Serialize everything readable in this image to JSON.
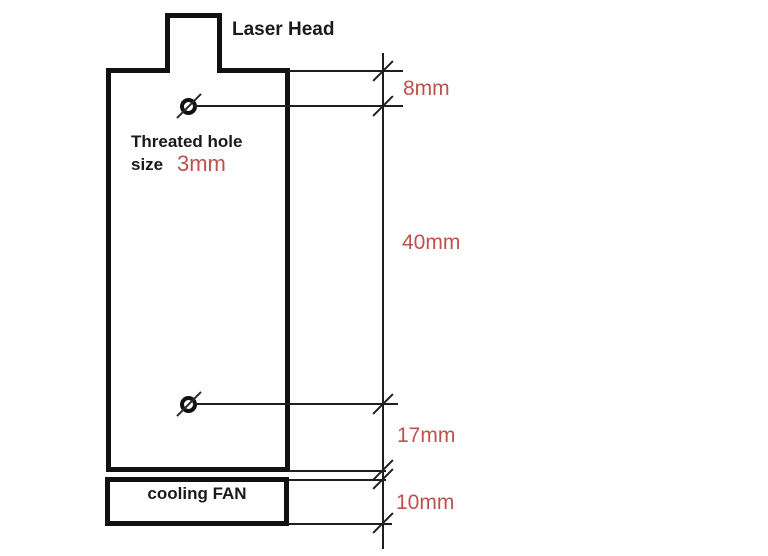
{
  "diagram": {
    "labels": {
      "laser_head": "Laser Head",
      "hole_note_line1": "Threated hole",
      "hole_note_line2": "size",
      "hole_size_value": "3mm",
      "cooling_fan": "cooling FAN"
    },
    "dimensions": {
      "top_edge_to_hole": "8mm",
      "hole_to_hole": "40mm",
      "hole_to_bottom": "17mm",
      "fan_height": "10mm"
    },
    "colors": {
      "outline": "#111111",
      "thin_line": "#1f1f1f",
      "dimension_text": "#c0504d",
      "background": "#ffffff"
    }
  }
}
